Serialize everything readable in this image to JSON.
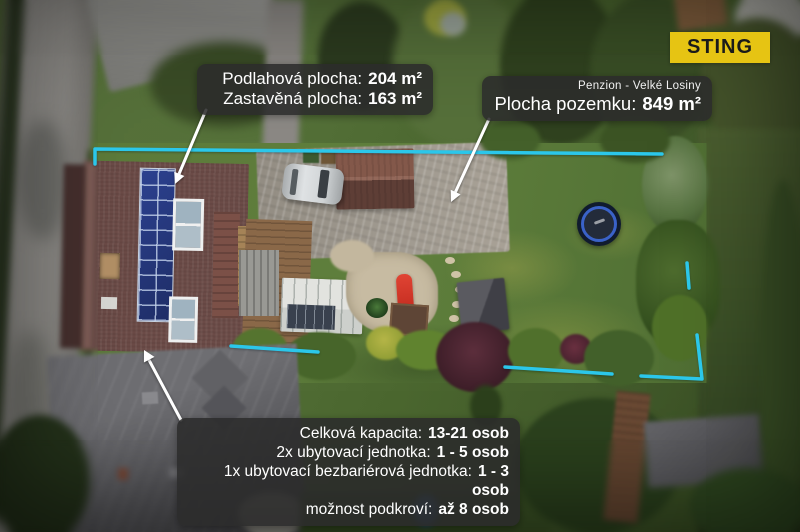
{
  "logo": {
    "text": "STING",
    "bg_color": "#e6c413",
    "text_color": "#1a1a1a"
  },
  "annotations": {
    "boundary_color": "#2bc7ea",
    "area_box": {
      "lines": [
        {
          "label": "Podlahová plocha:",
          "value": "204 m²"
        },
        {
          "label": "Zastavěná plocha:",
          "value": "163 m²"
        }
      ]
    },
    "plot_box": {
      "subtitle": "Penzion - Velké Losiny",
      "label": "Plocha pozemku:",
      "value": "849 m²"
    },
    "capacity_box": {
      "lines": [
        {
          "label": "Celková kapacita:",
          "value": "13-21 osob"
        },
        {
          "label": "2x ubytovací jednotka:",
          "value": "1 - 5 osob"
        },
        {
          "label": "1x ubytovací bezbariérová jednotka:",
          "value": "1 - 3 osob"
        },
        {
          "label": "možnost podkroví:",
          "value": "až 8 osob"
        }
      ]
    }
  }
}
